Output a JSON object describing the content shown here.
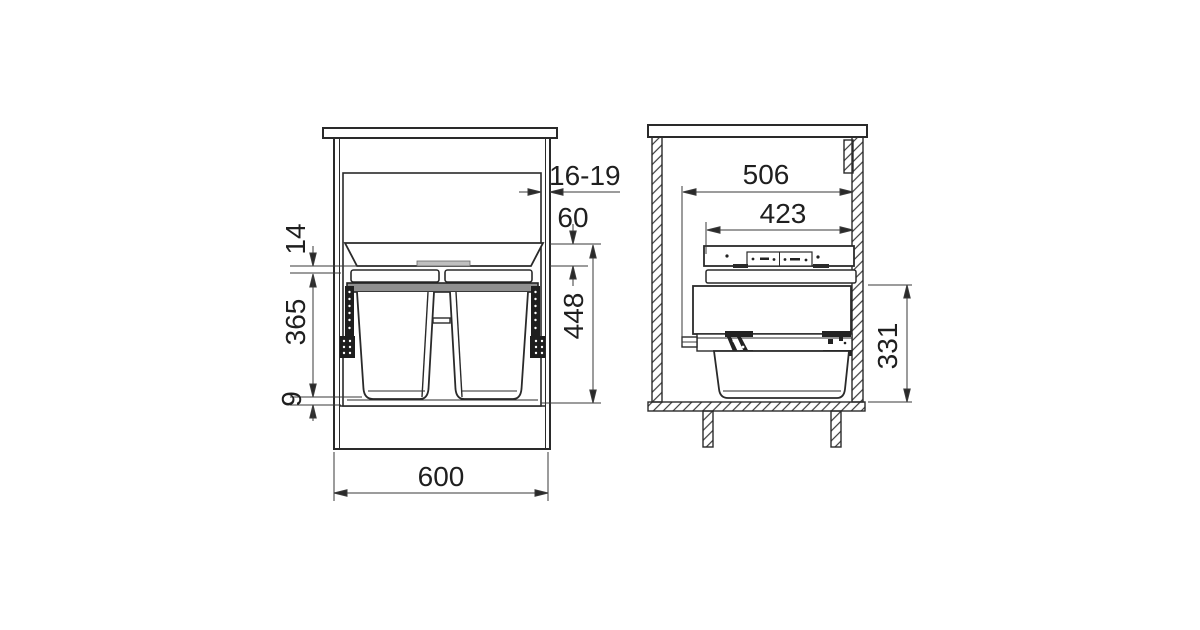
{
  "front_view": {
    "dimensions": {
      "door_thickness": "16-19",
      "top_clearance": "60",
      "lid_gap": "14",
      "bin_height": "365",
      "bottom_clearance": "9",
      "overall_height": "448",
      "cabinet_width": "600"
    }
  },
  "side_view": {
    "dimensions": {
      "min_depth": "506",
      "frame_depth": "423",
      "unit_height": "331"
    }
  },
  "style": {
    "background": "#ffffff",
    "line_color": "#2a2a2a",
    "dimension_line_color": "#3a3a3a",
    "rim_fill": "#8f8f8f",
    "lid_bar_fill": "#bfbfbf",
    "rail_fill": "#1e1e1e"
  }
}
